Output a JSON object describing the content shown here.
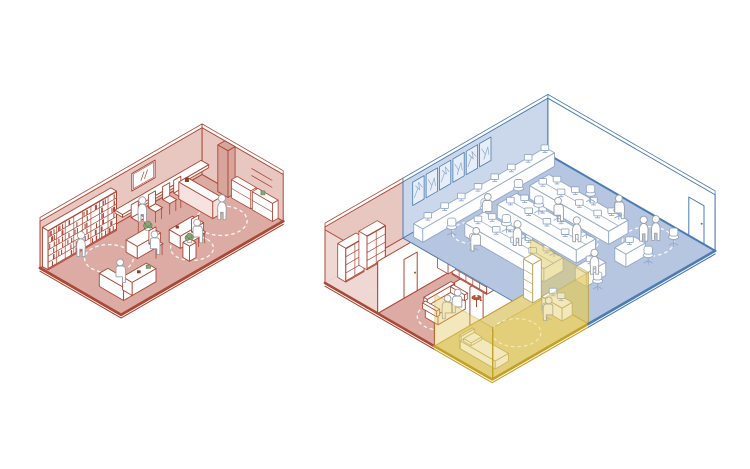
{
  "canvas": {
    "width": 750,
    "height": 469,
    "background": "#ffffff"
  },
  "colors": {
    "red_line": "#ac4836",
    "red_books": "#b5483a",
    "red_floor": "#dcaba3",
    "red_floor_light": "#eed8d3",
    "red_wall": "#e9c7c1",
    "red_wall_light": "#f0d9d4",
    "red_divider": "#d8a59c",
    "dark_red": "#8f3d2c",
    "blue_line": "#4b7cb3",
    "blue_wall": "#cbd8eb",
    "blue_floor": "#b6c5e0",
    "blue_poster": "#e7eef7",
    "blue_scribble": "#7d9cc4",
    "blue_furniture": "#93a9cb",
    "yellow_line": "#c3a127",
    "yellow_glass": "#e2ca5f",
    "yellow_floor": "#e5d48d",
    "yellow_soft": "#b9a85e",
    "green_plant": "#87a873",
    "green_dark": "#5f8050",
    "figure_fill": "#ffffff",
    "figure_line": "#9aa0a6",
    "white": "#ffffff",
    "dash": "#ffffff"
  },
  "left_diagram": {
    "name": "compact-shop-axonometric",
    "theme_color": "#ac4836",
    "figure_count": 6,
    "elements": [
      "bookshelf-wall",
      "wall-mirror",
      "bar-counter-with-chairs",
      "divider-panel",
      "service-counter",
      "reception-counter",
      "work-desks",
      "plants",
      "cabinet-units",
      "distancing-circles",
      "standing-figures",
      "seated-figures"
    ]
  },
  "right_diagram": {
    "name": "zoned-open-office-axonometric",
    "zones": [
      {
        "id": "red-zone",
        "color": "#ac4836",
        "figure_count": 2,
        "elements": [
          "storage-room",
          "storage-shelves",
          "interior-doors",
          "wall-shelf-grid",
          "sofa-with-two-figures",
          "side-table",
          "cabinet",
          "distancing-circles"
        ]
      },
      {
        "id": "blue-zone",
        "color": "#4b7cb3",
        "figure_count": 8,
        "elements": [
          "poster-wall",
          "entry-door",
          "wall-desk-counter",
          "desk-banks-with-monitors",
          "office-chairs",
          "distancing-circles",
          "standing-figures",
          "seated-figures"
        ]
      },
      {
        "id": "yellow-zone",
        "color": "#c3a127",
        "figure_count": 1,
        "elements": [
          "glass-partitions",
          "interior-door",
          "bed",
          "shelf-tower",
          "computer-desk",
          "office-chair",
          "distancing-circle"
        ]
      }
    ]
  }
}
